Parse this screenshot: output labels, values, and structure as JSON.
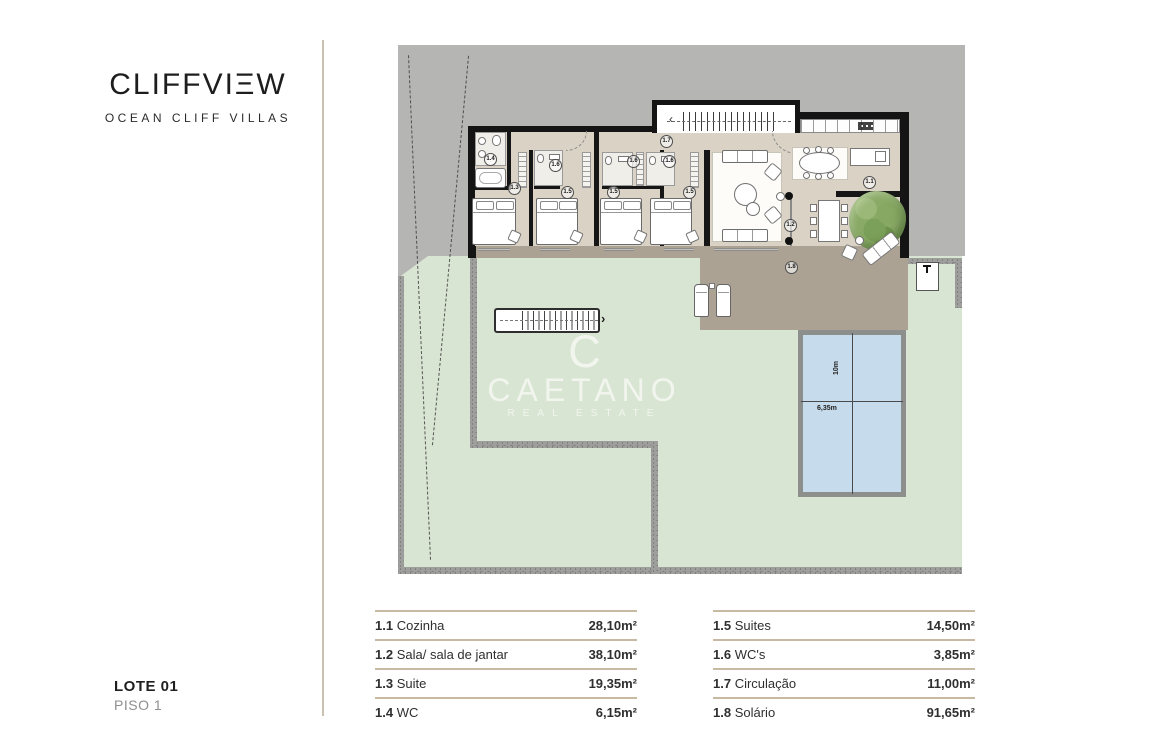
{
  "brand": {
    "logo": "CLIFFVIΞW",
    "subtitle": "OCEAN CLIFF VILLAS"
  },
  "footer": {
    "lot": "LOTE 01",
    "floor": "PISO 1"
  },
  "watermark": {
    "initial": "C",
    "name": "CAETANO",
    "tagline": "REAL ESTATE"
  },
  "plan": {
    "labels": {
      "kitchen": "1.1",
      "living": "1.2",
      "suite_master": "1.3",
      "wc_master": "1.4",
      "suite_2": "1.5",
      "suite_3": "1.5",
      "suite_4": "1.5",
      "wc_2": "1.6",
      "wc_3": "1.6",
      "wc_4": "1.6",
      "circulation": "1.7",
      "solarium": "1.8"
    },
    "pool": {
      "length_label": "10m",
      "width_label": "6,35m"
    },
    "stairs": {
      "up_arrow": "‹",
      "lawn_arrow": "›"
    }
  },
  "legend": {
    "left": [
      {
        "num": "1.1",
        "name": "Cozinha",
        "area": "28,10m²"
      },
      {
        "num": "1.2",
        "name": "Sala/ sala de jantar",
        "area": "38,10m²"
      },
      {
        "num": "1.3",
        "name": "Suite",
        "area": "19,35m²"
      },
      {
        "num": "1.4",
        "name": "WC",
        "area": "6,15m²"
      }
    ],
    "right": [
      {
        "num": "1.5",
        "name": "Suites",
        "area": "14,50m²"
      },
      {
        "num": "1.6",
        "name": "WC's",
        "area": "3,85m²"
      },
      {
        "num": "1.7",
        "name": "Circulação",
        "area": "11,00m²"
      },
      {
        "num": "1.8",
        "name": "Solário",
        "area": "91,65m²"
      }
    ]
  }
}
